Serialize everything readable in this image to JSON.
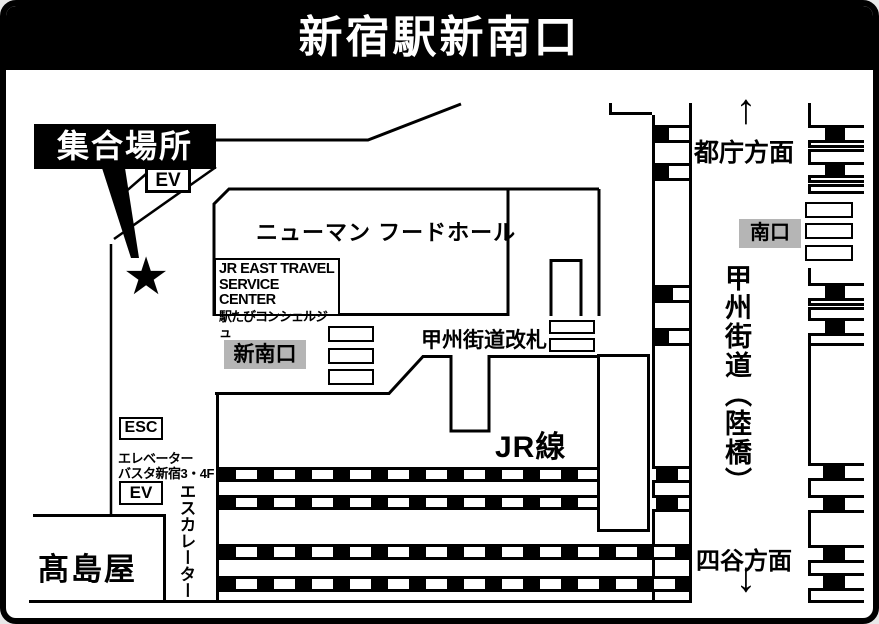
{
  "title": "新宿駅新南口",
  "colors": {
    "ink": "#000000",
    "paper": "#ffffff",
    "badge_gray": "#b5b5b5"
  },
  "meeting": {
    "label": "集合場所",
    "star": "★"
  },
  "boxes": {
    "ev_upper": "EV",
    "esc": "ESC",
    "ev_lower": "EV"
  },
  "buildings": {
    "food_hall": "ニューマン フードホール",
    "travel_center_line1": "JR EAST TRAVEL",
    "travel_center_line2": "SERVICE CENTER",
    "travel_center_line3": "駅たびコンシェルジュ",
    "takashimaya": "髙島屋"
  },
  "exits": {
    "shin_minami": "新南口",
    "minami": "南口",
    "koshu_gate": "甲州街道改札"
  },
  "directions": {
    "tocho": "都庁方面",
    "yotsuya": "四谷方面",
    "up_arrow": "↑",
    "down_arrow": "↓"
  },
  "roads": {
    "koshu_kaido": "甲州街道（陸橋）"
  },
  "rail": {
    "jr_line": "JR線"
  },
  "facilities": {
    "elevator": "エレベーター",
    "busta": "バスタ新宿3・4F",
    "escalator": "エスカレーター"
  }
}
